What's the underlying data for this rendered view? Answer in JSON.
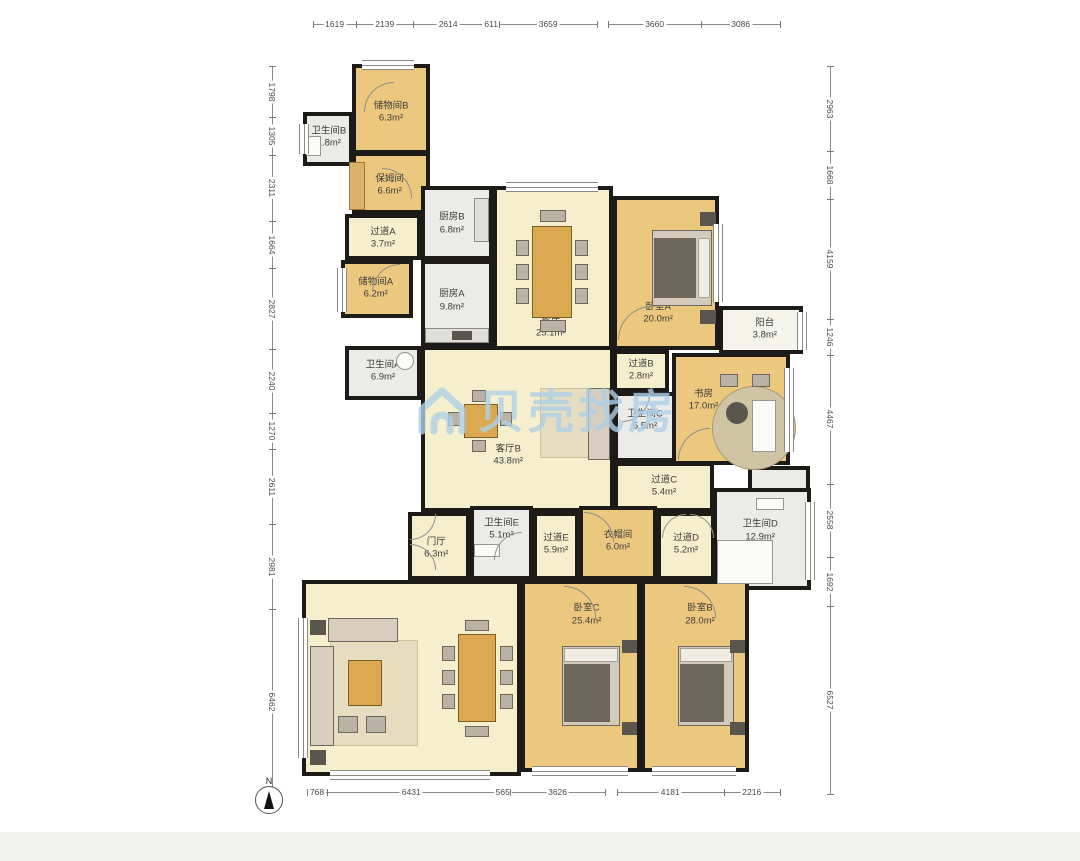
{
  "compass": {
    "label": "N"
  },
  "watermark": {
    "text": "贝壳找房",
    "color": "#aed0e8",
    "icon": "house-icon"
  },
  "colors": {
    "wall": "#1d1b17",
    "room_tan": "#ecc87f",
    "room_cream": "#f6efce",
    "room_white": "#ebebe8",
    "dim_text": "#4a4a4a",
    "watermark_blue": "#aed0e8"
  },
  "rooms": [
    {
      "id": "storage-b",
      "name": "储物间B",
      "area": "6.3m²",
      "type": "tan",
      "x": 352,
      "y": 64,
      "w": 78,
      "h": 90,
      "lx": 50,
      "ly": 55
    },
    {
      "id": "bath-b",
      "name": "卫生间B",
      "area": "1.8m²",
      "type": "white",
      "x": 303,
      "y": 112,
      "w": 50,
      "h": 54,
      "lx": 52,
      "ly": 48
    },
    {
      "id": "nanny-room",
      "name": "保姆间",
      "area": "6.6m²",
      "type": "tan",
      "x": 352,
      "y": 152,
      "w": 78,
      "h": 62,
      "lx": 48,
      "ly": 55
    },
    {
      "id": "corridor-a",
      "name": "过道A",
      "area": "3.7m²",
      "type": "cream",
      "x": 345,
      "y": 214,
      "w": 76,
      "h": 46,
      "lx": 50,
      "ly": 55
    },
    {
      "id": "storage-a",
      "name": "储物间A",
      "area": "6.2m²",
      "type": "tan",
      "x": 341,
      "y": 260,
      "w": 72,
      "h": 58,
      "lx": 48,
      "ly": 50
    },
    {
      "id": "kitchen-b",
      "name": "厨房B",
      "area": "6.8m²",
      "type": "white",
      "x": 421,
      "y": 186,
      "w": 72,
      "h": 74,
      "lx": 42,
      "ly": 52
    },
    {
      "id": "kitchen-a",
      "name": "厨房A",
      "area": "9.8m²",
      "type": "white",
      "x": 421,
      "y": 260,
      "w": 72,
      "h": 86,
      "lx": 42,
      "ly": 48
    },
    {
      "id": "bath-a",
      "name": "卫生间A",
      "area": "6.9m²",
      "type": "white",
      "x": 345,
      "y": 346,
      "w": 76,
      "h": 54,
      "lx": 50,
      "ly": 48
    },
    {
      "id": "dining",
      "name": "餐厅",
      "area": "25.1m²",
      "type": "cream",
      "x": 493,
      "y": 186,
      "w": 120,
      "h": 170,
      "lx": 48,
      "ly": 85
    },
    {
      "id": "bedroom-a",
      "name": "卧室A",
      "area": "20.0m²",
      "type": "tan",
      "x": 613,
      "y": 196,
      "w": 106,
      "h": 154,
      "lx": 42,
      "ly": 78
    },
    {
      "id": "balcony",
      "name": "阳台",
      "area": "3.8m²",
      "type": "white2",
      "x": 719,
      "y": 306,
      "w": 84,
      "h": 48,
      "lx": 55,
      "ly": 50
    },
    {
      "id": "corridor-b",
      "name": "过道B",
      "area": "2.8m²",
      "type": "cream",
      "x": 613,
      "y": 350,
      "w": 56,
      "h": 42,
      "lx": 50,
      "ly": 50
    },
    {
      "id": "study",
      "name": "书房",
      "area": "17.0m²",
      "type": "tan",
      "x": 672,
      "y": 353,
      "w": 118,
      "h": 112,
      "lx": 25,
      "ly": 42
    },
    {
      "id": "bath-c",
      "name": "卫生间C",
      "area": "5.5m²",
      "type": "white",
      "x": 614,
      "y": 392,
      "w": 62,
      "h": 70,
      "lx": 50,
      "ly": 40
    },
    {
      "id": "living-b",
      "name": "客厅B",
      "area": "43.8m²",
      "type": "cream",
      "x": 421,
      "y": 346,
      "w": 193,
      "h": 166,
      "lx": 45,
      "ly": 67
    },
    {
      "id": "corridor-c",
      "name": "过道C",
      "area": "5.4m²",
      "type": "cream",
      "x": 614,
      "y": 462,
      "w": 100,
      "h": 50,
      "lx": 50,
      "ly": 50
    },
    {
      "id": "bath-d-ext",
      "name": "",
      "area": "",
      "type": "white",
      "x": 748,
      "y": 466,
      "w": 62,
      "h": 28,
      "lx": 50,
      "ly": 50
    },
    {
      "id": "bath-d",
      "name": "卫生间D",
      "area": "12.9m²",
      "type": "white",
      "x": 713,
      "y": 488,
      "w": 98,
      "h": 102,
      "lx": 48,
      "ly": 42
    },
    {
      "id": "foyer",
      "name": "门厅",
      "area": "6.3m²",
      "type": "cream",
      "x": 408,
      "y": 512,
      "w": 62,
      "h": 68,
      "lx": 45,
      "ly": 55
    },
    {
      "id": "bath-e",
      "name": "卫生间E",
      "area": "5.1m²",
      "type": "white",
      "x": 470,
      "y": 506,
      "w": 63,
      "h": 74,
      "lx": 50,
      "ly": 30
    },
    {
      "id": "corridor-e",
      "name": "过道E",
      "area": "5.9m²",
      "type": "cream",
      "x": 533,
      "y": 512,
      "w": 46,
      "h": 68,
      "lx": 50,
      "ly": 48
    },
    {
      "id": "cloakroom",
      "name": "衣帽间",
      "area": "6.0m²",
      "type": "tan",
      "x": 579,
      "y": 506,
      "w": 78,
      "h": 74,
      "lx": 50,
      "ly": 48
    },
    {
      "id": "corridor-d",
      "name": "过道D",
      "area": "5.2m²",
      "type": "cream",
      "x": 657,
      "y": 512,
      "w": 58,
      "h": 68,
      "lx": 50,
      "ly": 48
    },
    {
      "id": "living-a",
      "name": "客厅A",
      "area": "53.8m²",
      "type": "cream",
      "x": 302,
      "y": 580,
      "w": 219,
      "h": 196,
      "lx": 44,
      "ly": 48
    },
    {
      "id": "bedroom-c",
      "name": "卧室C",
      "area": "25.4m²",
      "type": "tan",
      "x": 521,
      "y": 580,
      "w": 120,
      "h": 192,
      "lx": 55,
      "ly": 17
    },
    {
      "id": "bedroom-b",
      "name": "卧室B",
      "area": "28.0m²",
      "type": "tan",
      "x": 641,
      "y": 580,
      "w": 108,
      "h": 192,
      "lx": 55,
      "ly": 17
    }
  ],
  "dimensions": {
    "top": [
      {
        "x": 313,
        "y": 24,
        "len": 284,
        "segments": [
          "1619",
          "2139",
          "2614",
          "611",
          "3659"
        ]
      },
      {
        "x": 608,
        "y": 24,
        "len": 172,
        "segments": [
          "3660",
          "3086"
        ]
      }
    ],
    "bottom": [
      {
        "x": 307,
        "y": 792,
        "len": 298,
        "segments": [
          "768",
          "6431",
          "565",
          "3626"
        ]
      },
      {
        "x": 617,
        "y": 792,
        "len": 163,
        "segments": [
          "4181",
          "2216"
        ]
      }
    ],
    "left": [
      {
        "x": 272,
        "y": 66,
        "len": 728,
        "segments": [
          "1798",
          "1305",
          "2311",
          "1664",
          "2827",
          "2240",
          "1270",
          "2611",
          "2981",
          "6462"
        ]
      }
    ],
    "right": [
      {
        "x": 830,
        "y": 66,
        "len": 728,
        "segments": [
          "2963",
          "1668",
          "4159",
          "1246",
          "4467",
          "2558",
          "1692",
          "6527"
        ]
      }
    ]
  },
  "windows": [
    {
      "id": "win-storage-b-top",
      "o": "h",
      "x": 362,
      "y": 60,
      "w": 52,
      "h": 8
    },
    {
      "id": "win-dining-top",
      "o": "h",
      "x": 506,
      "y": 182,
      "w": 92,
      "h": 8
    },
    {
      "id": "win-bedroom-a-right",
      "o": "v",
      "x": 713,
      "y": 224,
      "w": 8,
      "h": 78
    },
    {
      "id": "win-balcony-right",
      "o": "v",
      "x": 797,
      "y": 312,
      "w": 8,
      "h": 38
    },
    {
      "id": "win-study-right",
      "o": "v",
      "x": 784,
      "y": 368,
      "w": 8,
      "h": 84
    },
    {
      "id": "win-bath-d-right",
      "o": "v",
      "x": 805,
      "y": 502,
      "w": 8,
      "h": 78
    },
    {
      "id": "win-living-a-left",
      "o": "v",
      "x": 298,
      "y": 618,
      "w": 8,
      "h": 140
    },
    {
      "id": "win-living-a-bottom",
      "o": "h",
      "x": 330,
      "y": 770,
      "w": 160,
      "h": 8
    },
    {
      "id": "win-bedroom-c-bottom",
      "o": "h",
      "x": 532,
      "y": 766,
      "w": 96,
      "h": 8
    },
    {
      "id": "win-bedroom-b-bottom",
      "o": "h",
      "x": 652,
      "y": 766,
      "w": 84,
      "h": 8
    },
    {
      "id": "win-storage-a-left",
      "o": "v",
      "x": 337,
      "y": 268,
      "w": 8,
      "h": 44
    },
    {
      "id": "win-bath-b-left",
      "o": "v",
      "x": 299,
      "y": 124,
      "w": 8,
      "h": 30
    }
  ],
  "doors": [
    {
      "id": "door-storage-b",
      "x": 364,
      "y": 82,
      "r": 30,
      "rot": 0
    },
    {
      "id": "door-nanny",
      "x": 382,
      "y": 168,
      "r": 30,
      "rot": 90
    },
    {
      "id": "door-storage-a",
      "x": 372,
      "y": 264,
      "r": 28,
      "rot": 0
    },
    {
      "id": "door-bedroom-a",
      "x": 618,
      "y": 306,
      "r": 34,
      "rot": 0
    },
    {
      "id": "door-foyer-1",
      "x": 410,
      "y": 514,
      "r": 26,
      "rot": 180
    },
    {
      "id": "door-foyer-2",
      "x": 410,
      "y": 544,
      "r": 26,
      "rot": 90
    },
    {
      "id": "door-bath-e",
      "x": 494,
      "y": 532,
      "r": 28,
      "rot": 0
    },
    {
      "id": "door-cloakroom",
      "x": 584,
      "y": 512,
      "r": 30,
      "rot": 90
    },
    {
      "id": "door-corridor-d-1",
      "x": 662,
      "y": 514,
      "r": 24,
      "rot": 0
    },
    {
      "id": "door-corridor-d-2",
      "x": 690,
      "y": 514,
      "r": 24,
      "rot": 90
    },
    {
      "id": "door-bedroom-c",
      "x": 564,
      "y": 586,
      "r": 32,
      "rot": 90
    },
    {
      "id": "door-bedroom-b",
      "x": 684,
      "y": 586,
      "r": 32,
      "rot": 90
    },
    {
      "id": "door-study",
      "x": 678,
      "y": 428,
      "r": 32,
      "rot": 0
    },
    {
      "id": "door-bath-c",
      "x": 622,
      "y": 394,
      "r": 28,
      "rot": 180
    }
  ],
  "furniture": [
    {
      "id": "dining-table",
      "kind": "table",
      "x": 532,
      "y": 226,
      "w": 40,
      "h": 92
    },
    {
      "id": "dining-chair-1",
      "kind": "chair",
      "x": 516,
      "y": 240,
      "w": 13,
      "h": 16
    },
    {
      "id": "dining-chair-2",
      "kind": "chair",
      "x": 516,
      "y": 264,
      "w": 13,
      "h": 16
    },
    {
      "id": "dining-chair-3",
      "kind": "chair",
      "x": 516,
      "y": 288,
      "w": 13,
      "h": 16
    },
    {
      "id": "dining-chair-4",
      "kind": "chair",
      "x": 575,
      "y": 240,
      "w": 13,
      "h": 16
    },
    {
      "id": "dining-chair-5",
      "kind": "chair",
      "x": 575,
      "y": 264,
      "w": 13,
      "h": 16
    },
    {
      "id": "dining-chair-6",
      "kind": "chair",
      "x": 575,
      "y": 288,
      "w": 13,
      "h": 16
    },
    {
      "id": "dining-chair-7",
      "kind": "chair",
      "x": 540,
      "y": 210,
      "w": 26,
      "h": 12
    },
    {
      "id": "dining-chair-8",
      "kind": "chair",
      "x": 540,
      "y": 320,
      "w": 26,
      "h": 12
    },
    {
      "id": "living-b-rug",
      "kind": "rug",
      "x": 540,
      "y": 388,
      "w": 58,
      "h": 70
    },
    {
      "id": "living-b-sofa",
      "kind": "sofa",
      "x": 588,
      "y": 388,
      "w": 22,
      "h": 72
    },
    {
      "id": "living-b-table",
      "kind": "table",
      "x": 464,
      "y": 404,
      "w": 34,
      "h": 34
    },
    {
      "id": "living-b-chair-1",
      "kind": "chair",
      "x": 448,
      "y": 412,
      "w": 12,
      "h": 14
    },
    {
      "id": "living-b-chair-2",
      "kind": "chair",
      "x": 500,
      "y": 412,
      "w": 12,
      "h": 14
    },
    {
      "id": "living-b-chair-3",
      "kind": "chair",
      "x": 472,
      "y": 390,
      "w": 14,
      "h": 12
    },
    {
      "id": "living-b-chair-4",
      "kind": "chair",
      "x": 472,
      "y": 440,
      "w": 14,
      "h": 12
    },
    {
      "id": "bedroom-a-bed",
      "kind": "bed",
      "x": 652,
      "y": 230,
      "w": 60,
      "h": 76
    },
    {
      "id": "bedroom-a-blanket",
      "kind": "blanket",
      "x": 654,
      "y": 238,
      "w": 42,
      "h": 60
    },
    {
      "id": "bedroom-a-pillow",
      "kind": "pillow",
      "x": 698,
      "y": 238,
      "w": 12,
      "h": 60
    },
    {
      "id": "bedroom-a-nightstand-1",
      "kind": "dark",
      "x": 700,
      "y": 212,
      "w": 16,
      "h": 14
    },
    {
      "id": "bedroom-a-nightstand-2",
      "kind": "dark",
      "x": 700,
      "y": 310,
      "w": 16,
      "h": 14
    },
    {
      "id": "study-rug",
      "kind": "round",
      "x": 712,
      "y": 386,
      "w": 84,
      "h": 84
    },
    {
      "id": "study-desk",
      "kind": "white",
      "x": 752,
      "y": 400,
      "w": 24,
      "h": 52
    },
    {
      "id": "study-chair",
      "kind": "darkround",
      "x": 726,
      "y": 402,
      "w": 22,
      "h": 22
    },
    {
      "id": "study-seat-1",
      "kind": "chair",
      "x": 720,
      "y": 374,
      "w": 18,
      "h": 13
    },
    {
      "id": "study-seat-2",
      "kind": "chair",
      "x": 752,
      "y": 374,
      "w": 18,
      "h": 13
    },
    {
      "id": "kitchen-a-counter",
      "kind": "counter",
      "x": 425,
      "y": 328,
      "w": 64,
      "h": 15
    },
    {
      "id": "kitchen-a-stove",
      "kind": "dark",
      "x": 452,
      "y": 331,
      "w": 20,
      "h": 9
    },
    {
      "id": "kitchen-b-counter",
      "kind": "counter",
      "x": 474,
      "y": 198,
      "w": 15,
      "h": 44
    },
    {
      "id": "bath-d-tub",
      "kind": "white",
      "x": 717,
      "y": 540,
      "w": 56,
      "h": 44
    },
    {
      "id": "bath-d-shelf",
      "kind": "white",
      "x": 756,
      "y": 498,
      "w": 28,
      "h": 12
    },
    {
      "id": "bath-e-sink",
      "kind": "white",
      "x": 474,
      "y": 544,
      "w": 26,
      "h": 13
    },
    {
      "id": "bath-b-toilet",
      "kind": "white",
      "x": 306,
      "y": 136,
      "w": 15,
      "h": 20
    },
    {
      "id": "bath-a-washer",
      "kind": "whiteround",
      "x": 396,
      "y": 352,
      "w": 18,
      "h": 18
    },
    {
      "id": "nanny-bed",
      "kind": "tanbed",
      "x": 349,
      "y": 162,
      "w": 16,
      "h": 48
    },
    {
      "id": "living-a-rug",
      "kind": "rug",
      "x": 330,
      "y": 640,
      "w": 88,
      "h": 106
    },
    {
      "id": "living-a-sofa-1",
      "kind": "sofa",
      "x": 310,
      "y": 646,
      "w": 24,
      "h": 100
    },
    {
      "id": "living-a-sofa-2",
      "kind": "sofa",
      "x": 328,
      "y": 618,
      "w": 70,
      "h": 24
    },
    {
      "id": "living-a-coffee-table",
      "kind": "table",
      "x": 348,
      "y": 660,
      "w": 34,
      "h": 46
    },
    {
      "id": "living-a-ottoman-1",
      "kind": "chair",
      "x": 338,
      "y": 716,
      "w": 20,
      "h": 17
    },
    {
      "id": "living-a-ottoman-2",
      "kind": "chair",
      "x": 366,
      "y": 716,
      "w": 20,
      "h": 17
    },
    {
      "id": "living-a-side-table-1",
      "kind": "dark",
      "x": 310,
      "y": 620,
      "w": 16,
      "h": 15
    },
    {
      "id": "living-a-side-table-2",
      "kind": "dark",
      "x": 310,
      "y": 750,
      "w": 16,
      "h": 15
    },
    {
      "id": "living-a-table",
      "kind": "table",
      "x": 458,
      "y": 634,
      "w": 38,
      "h": 88
    },
    {
      "id": "living-a-chair-1",
      "kind": "chair",
      "x": 442,
      "y": 646,
      "w": 13,
      "h": 15
    },
    {
      "id": "living-a-chair-2",
      "kind": "chair",
      "x": 442,
      "y": 670,
      "w": 13,
      "h": 15
    },
    {
      "id": "living-a-chair-3",
      "kind": "chair",
      "x": 442,
      "y": 694,
      "w": 13,
      "h": 15
    },
    {
      "id": "living-a-chair-4",
      "kind": "chair",
      "x": 500,
      "y": 646,
      "w": 13,
      "h": 15
    },
    {
      "id": "living-a-chair-5",
      "kind": "chair",
      "x": 500,
      "y": 670,
      "w": 13,
      "h": 15
    },
    {
      "id": "living-a-chair-6",
      "kind": "chair",
      "x": 500,
      "y": 694,
      "w": 13,
      "h": 15
    },
    {
      "id": "living-a-chair-7",
      "kind": "chair",
      "x": 465,
      "y": 620,
      "w": 24,
      "h": 11
    },
    {
      "id": "living-a-chair-8",
      "kind": "chair",
      "x": 465,
      "y": 726,
      "w": 24,
      "h": 11
    },
    {
      "id": "bedroom-c-bed",
      "kind": "bed",
      "x": 562,
      "y": 646,
      "w": 58,
      "h": 80
    },
    {
      "id": "bedroom-c-pillow",
      "kind": "pillow",
      "x": 564,
      "y": 648,
      "w": 54,
      "h": 14
    },
    {
      "id": "bedroom-c-blanket",
      "kind": "blanket",
      "x": 564,
      "y": 664,
      "w": 46,
      "h": 58
    },
    {
      "id": "bedroom-c-nightstand-1",
      "kind": "dark",
      "x": 622,
      "y": 640,
      "w": 15,
      "h": 13
    },
    {
      "id": "bedroom-c-nightstand-2",
      "kind": "dark",
      "x": 622,
      "y": 722,
      "w": 15,
      "h": 13
    },
    {
      "id": "bedroom-b-bed",
      "kind": "bed",
      "x": 678,
      "y": 646,
      "w": 56,
      "h": 80
    },
    {
      "id": "bedroom-b-pillow",
      "kind": "pillow",
      "x": 680,
      "y": 648,
      "w": 52,
      "h": 14
    },
    {
      "id": "bedroom-b-blanket",
      "kind": "blanket",
      "x": 680,
      "y": 664,
      "w": 44,
      "h": 58
    },
    {
      "id": "bedroom-b-nightstand-1",
      "kind": "dark",
      "x": 730,
      "y": 640,
      "w": 15,
      "h": 13
    },
    {
      "id": "bedroom-b-nightstand-2",
      "kind": "dark",
      "x": 730,
      "y": 722,
      "w": 15,
      "h": 13
    }
  ]
}
